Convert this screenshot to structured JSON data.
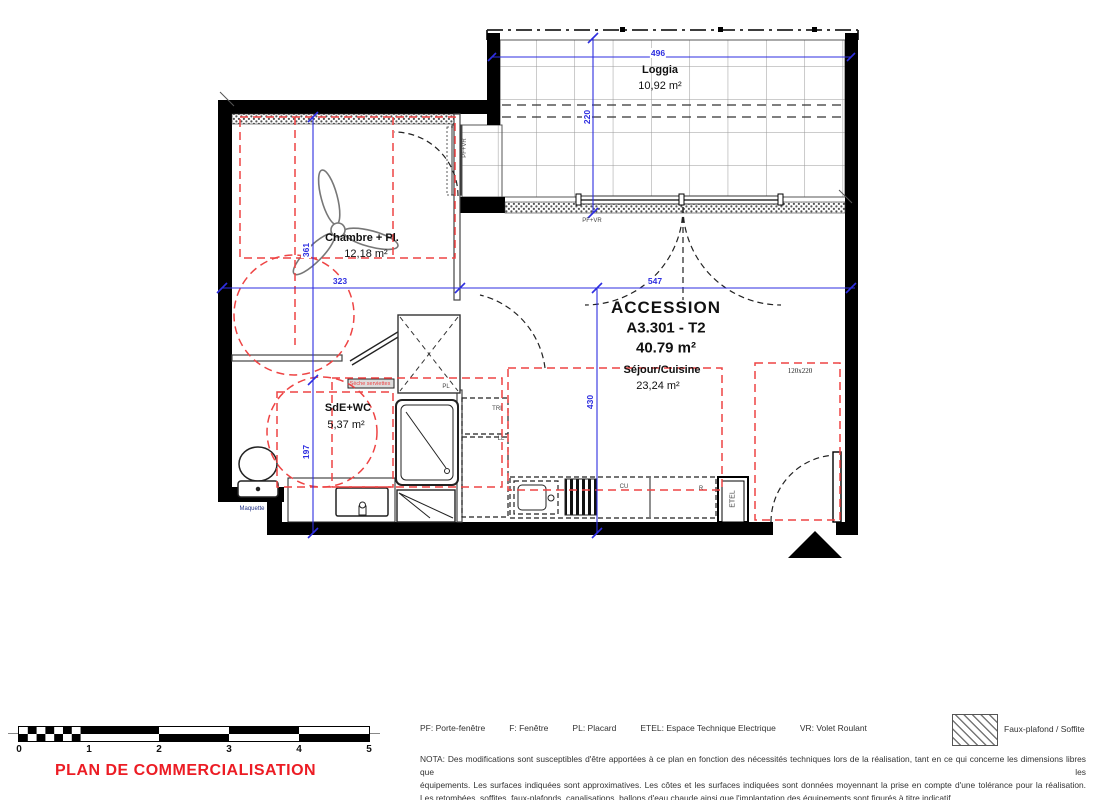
{
  "header": {
    "program": "ACCESSION",
    "lot": "A3.301 - T2",
    "area": "40.79 m²"
  },
  "rooms": {
    "loggia": {
      "name": "Loggia",
      "area": "10,92 m²"
    },
    "chambre": {
      "name": "Chambre + Pl.",
      "area": "12,18 m²"
    },
    "sejour": {
      "name": "Séjour/Cuisine",
      "area": "23,24 m²"
    },
    "sde": {
      "name": "SdE+WC",
      "area": "5,37 m²"
    }
  },
  "dims": {
    "loggia_w": "496",
    "loggia_d": "220",
    "chambre_w": "323",
    "chambre_h": "361",
    "sde_h": "197",
    "sejour_w": "547",
    "sejour_h": "430"
  },
  "annotations": {
    "pf_vr_top": "PF+VR",
    "pf_vr_side": "PF+VR",
    "door_size": "120x220",
    "pl": "PL",
    "tri": "TRI",
    "ll": "LL",
    "cu": "CU",
    "r": "R",
    "etel": "ETEL",
    "maquette": "Maquette",
    "seche_serviettes": "Sèche serviettes"
  },
  "legend": {
    "items": [
      {
        "label": "PF: Porte-fenêtre"
      },
      {
        "label": "F: Fenêtre"
      },
      {
        "label": "PL: Placard"
      },
      {
        "label": "ETEL: Espace Technique Electrique"
      },
      {
        "label": "VR: Volet Roulant"
      }
    ],
    "hatch_label": "Faux-plafond / Soffite"
  },
  "nota": {
    "line1": "NOTA: Des modifications sont susceptibles d'être apportées à ce plan en fonction des nécessités techniques lors de la réalisation, tant en ce qui concerne les dimensions libres que les",
    "line2": "équipements. Les surfaces indiquées sont approximatives. Les côtes et les surfaces indiquées sont données moyennant la prise en compte d'une tolérance pour la réalisation.",
    "line3": "Les retombées, soffites, faux-plafonds, canalisations, ballons d'eau chaude ainsi que l'implantation des équipements sont figurés à titre indicatif."
  },
  "scale_bar": {
    "ticks": [
      "0",
      "1",
      "2",
      "3",
      "4",
      "5"
    ]
  },
  "footer": {
    "title": "PLAN DE COMMERCIALISATION"
  },
  "colors": {
    "dimension_blue": "#2e2ee0",
    "faux_plafond_red": "#ee4444",
    "title_red": "#ec1c24",
    "wall_black": "#000000"
  }
}
